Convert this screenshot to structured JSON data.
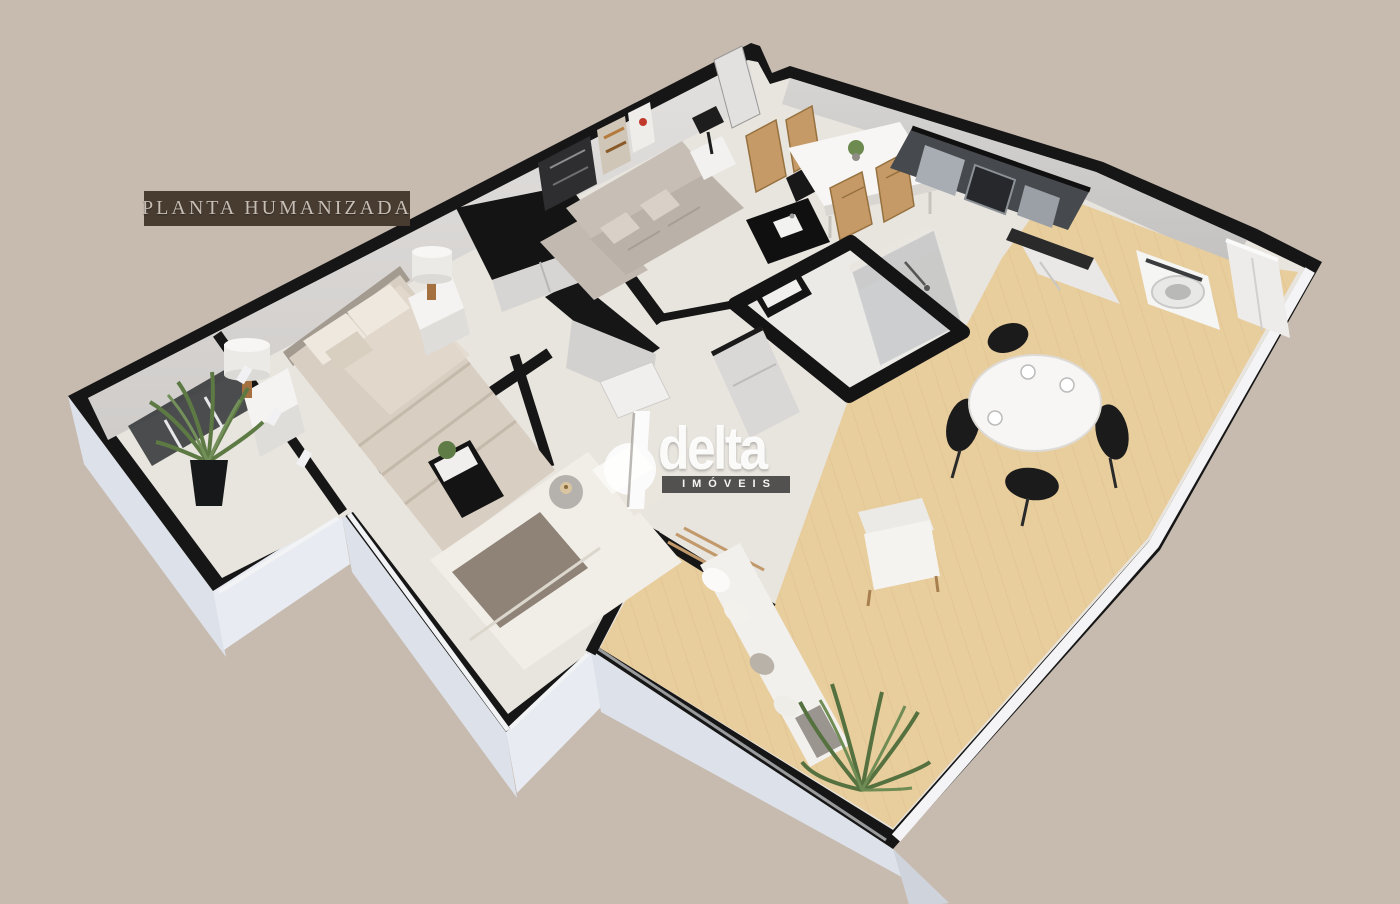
{
  "badge": {
    "label": "PLANTA HUMANIZADA"
  },
  "watermark": {
    "brand": "delta",
    "tagline": "IMÓVEIS"
  },
  "colors": {
    "background": "#c7bbb0",
    "badge_bg": "#483c31",
    "badge_text": "#c6beb4",
    "walls": "#161616",
    "wall_face": "#d8d5d3",
    "skirt": "#dde1e9",
    "floor_tile": "#e8e4de",
    "deck_wood": "#e8cd9d",
    "plant_green": "#5d7a44",
    "watermark_white": "#ffffff",
    "watermark_strip": "#3c3c3c"
  }
}
